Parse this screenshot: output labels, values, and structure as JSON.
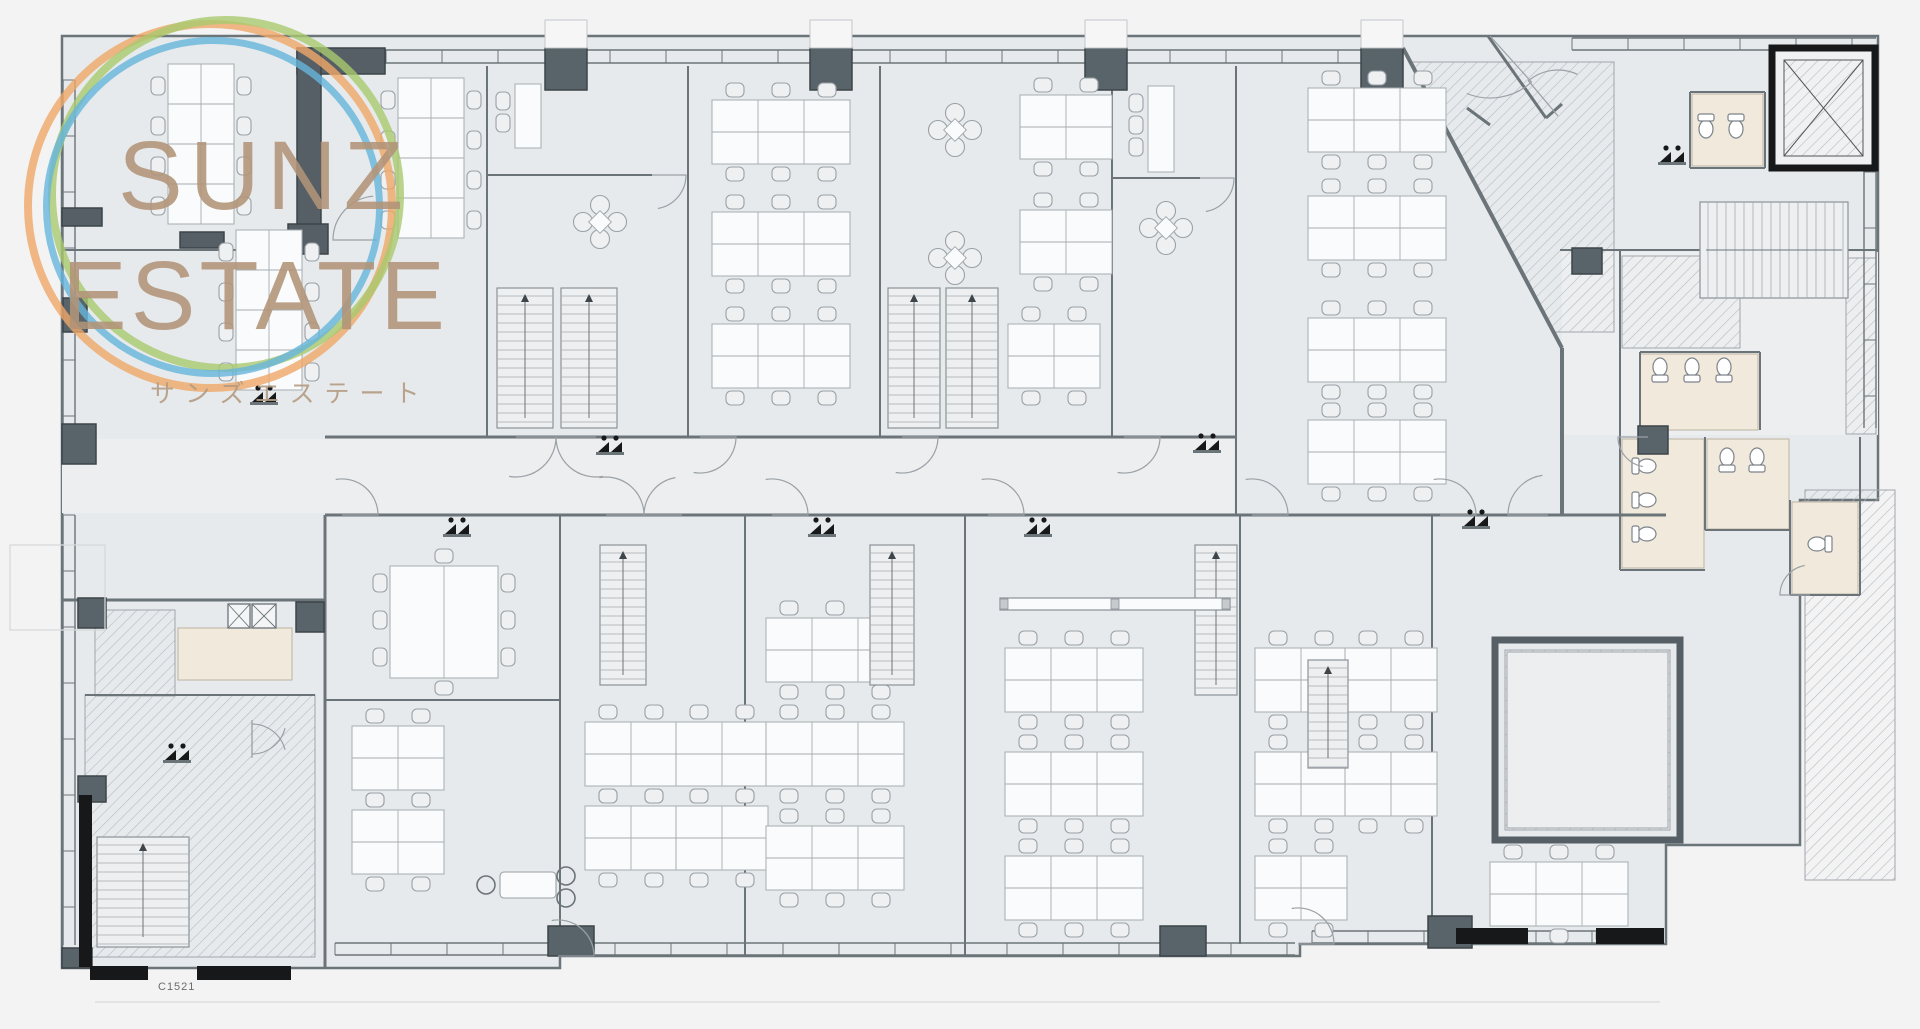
{
  "watermark": {
    "line1": "SUNZ",
    "line2": "ESTATE",
    "line3": "サンズエステート",
    "ring_colors": {
      "orange": "#efa768",
      "green": "#a9c96e",
      "blue": "#67b5dc"
    },
    "text_color": "#b29478"
  },
  "drawing_label": {
    "text": "C1521"
  },
  "palette": {
    "outside": "#f3f3f4",
    "floor": "#e7eaec",
    "floor2": "#eceef0",
    "wall": "#6b7479",
    "wall_dark": "#555f65",
    "column": "#59646a",
    "column_stroke": "#3d454a",
    "line": "#a0a6ab",
    "line_soft": "#c3c7cb",
    "white": "#fafbfc",
    "beige": "#f0e9dc",
    "beige_stroke": "#bcb2a1",
    "hatch": "#b6bbbf",
    "black": "#17181a"
  },
  "plan": {
    "outline": [
      [
        62,
        36
      ],
      [
        1878,
        36
      ],
      [
        1878,
        500
      ],
      [
        1800,
        500
      ],
      [
        1800,
        845
      ],
      [
        1666,
        845
      ],
      [
        1666,
        944
      ],
      [
        1300,
        944
      ],
      [
        1300,
        956
      ],
      [
        560,
        956
      ],
      [
        560,
        968
      ],
      [
        62,
        968
      ]
    ],
    "corridors": [
      [
        62,
        439,
        1172,
        74
      ],
      [
        1562,
        252,
        316,
        183
      ]
    ],
    "hatch_rects": [
      [
        95,
        610,
        80,
        86
      ],
      [
        85,
        695,
        230,
        262
      ],
      [
        1505,
        650,
        165,
        180
      ],
      [
        1805,
        490,
        90,
        390
      ],
      [
        1846,
        258,
        30,
        176
      ],
      [
        1622,
        256,
        118,
        92
      ]
    ],
    "hatch_polys": [
      [
        [
          1412,
          62
        ],
        [
          1554,
          332
        ],
        [
          1614,
          332
        ],
        [
          1614,
          62
        ]
      ]
    ],
    "beige_rooms": [
      [
        178,
        628,
        114,
        52
      ],
      [
        1622,
        439,
        82,
        129
      ],
      [
        1707,
        439,
        82,
        90
      ],
      [
        1792,
        502,
        66,
        92
      ],
      [
        1640,
        354,
        118,
        76
      ],
      [
        1692,
        94,
        71,
        72
      ]
    ],
    "facades": [
      {
        "d": "h",
        "a": 330,
        "b": 1398,
        "p": 50,
        "g": 13,
        "t": 56
      },
      {
        "d": "h",
        "a": 1572,
        "b": 1876,
        "p": 38,
        "g": 12,
        "t": 56
      },
      {
        "d": "v",
        "a": 80,
        "b": 430,
        "p": 63,
        "g": 12,
        "t": 56
      },
      {
        "d": "v",
        "a": 515,
        "b": 945,
        "p": 63,
        "g": 12,
        "t": 56
      },
      {
        "d": "h",
        "a": 335,
        "b": 1295,
        "p": 943,
        "g": 12,
        "t": 56
      },
      {
        "d": "h",
        "a": 1312,
        "b": 1660,
        "p": 931,
        "g": 12,
        "t": 56
      },
      {
        "d": "v",
        "a": 60,
        "b": 428,
        "p": 1864,
        "g": 12,
        "t": 56
      }
    ],
    "walls": [
      [
        487,
        66,
        487,
        437,
        2
      ],
      [
        688,
        66,
        688,
        437,
        2
      ],
      [
        880,
        66,
        880,
        437,
        2
      ],
      [
        1112,
        66,
        1112,
        437,
        2
      ],
      [
        1236,
        66,
        1236,
        515,
        2
      ],
      [
        487,
        175,
        652,
        175,
        2
      ],
      [
        1112,
        178,
        1200,
        178,
        2
      ],
      [
        325,
        437,
        1236,
        437,
        3
      ],
      [
        325,
        515,
        1666,
        515,
        3
      ],
      [
        62,
        250,
        298,
        250,
        2
      ],
      [
        325,
        515,
        325,
        968,
        3
      ],
      [
        560,
        515,
        560,
        956,
        2
      ],
      [
        745,
        515,
        745,
        956,
        2
      ],
      [
        965,
        515,
        965,
        956,
        2
      ],
      [
        1240,
        515,
        1240,
        944,
        2
      ],
      [
        1432,
        515,
        1432,
        944,
        2
      ],
      [
        325,
        700,
        560,
        700,
        2
      ],
      [
        62,
        600,
        325,
        600,
        3
      ],
      [
        85,
        695,
        315,
        695,
        2
      ],
      [
        1562,
        348,
        1562,
        515,
        4
      ],
      [
        1560,
        250,
        1878,
        250,
        2
      ],
      [
        1620,
        250,
        1620,
        437,
        2
      ],
      [
        1640,
        352,
        1640,
        430,
        2
      ],
      [
        1640,
        352,
        1760,
        352,
        2
      ],
      [
        1760,
        352,
        1760,
        430,
        2
      ],
      [
        1620,
        437,
        1620,
        570,
        2
      ],
      [
        1620,
        570,
        1705,
        570,
        2
      ],
      [
        1705,
        437,
        1705,
        530,
        2
      ],
      [
        1705,
        530,
        1790,
        530,
        2
      ],
      [
        1790,
        500,
        1790,
        595,
        2
      ],
      [
        1790,
        595,
        1860,
        595,
        2
      ],
      [
        1860,
        437,
        1860,
        595,
        2
      ],
      [
        1690,
        92,
        1690,
        168,
        2
      ],
      [
        1690,
        92,
        1765,
        92,
        2
      ],
      [
        1765,
        92,
        1765,
        168,
        2
      ],
      [
        1690,
        168,
        1765,
        168,
        2
      ],
      [
        1403,
        48,
        1562,
        348,
        4
      ],
      [
        1488,
        36,
        1546,
        118,
        3
      ],
      [
        1546,
        118,
        1562,
        104,
        3
      ],
      [
        1467,
        108,
        1490,
        125,
        3
      ]
    ],
    "columns": [
      [
        545,
        48,
        42,
        42
      ],
      [
        810,
        48,
        42,
        42
      ],
      [
        1085,
        48,
        42,
        42
      ],
      [
        1361,
        48,
        42,
        42
      ],
      [
        63,
        298,
        24,
        34
      ],
      [
        62,
        424,
        34,
        40
      ],
      [
        78,
        598,
        28,
        30
      ],
      [
        78,
        776,
        28,
        26
      ],
      [
        62,
        948,
        30,
        20
      ],
      [
        296,
        602,
        28,
        30
      ],
      [
        1638,
        426,
        30,
        28
      ],
      [
        1572,
        248,
        30,
        26
      ],
      [
        1750,
        248,
        36,
        26
      ],
      [
        548,
        926,
        46,
        30
      ],
      [
        1160,
        926,
        46,
        30
      ],
      [
        1428,
        916,
        44,
        32
      ]
    ],
    "dark_rects": [
      [
        297,
        48,
        88,
        26
      ],
      [
        297,
        48,
        24,
        180
      ],
      [
        288,
        224,
        40,
        30
      ],
      [
        180,
        232,
        44,
        16
      ],
      [
        62,
        208,
        40,
        18
      ]
    ],
    "black_rects": [
      [
        79,
        795,
        13,
        172
      ],
      [
        90,
        966,
        58,
        14
      ],
      [
        197,
        966,
        94,
        14
      ],
      [
        1456,
        928,
        72,
        16
      ],
      [
        1596,
        928,
        68,
        16
      ]
    ],
    "white_tops": [
      [
        545,
        20,
        42,
        28
      ],
      [
        810,
        20,
        42,
        28
      ],
      [
        1085,
        20,
        42,
        28
      ],
      [
        1361,
        20,
        42,
        28
      ]
    ],
    "clusters": [
      [
        712,
        100,
        3
      ],
      [
        712,
        212,
        3
      ],
      [
        712,
        324,
        3
      ],
      [
        1020,
        95,
        2
      ],
      [
        1020,
        210,
        2
      ],
      [
        1008,
        324,
        2
      ],
      [
        1308,
        88,
        3
      ],
      [
        1308,
        196,
        3
      ],
      [
        1308,
        318,
        3
      ],
      [
        1308,
        420,
        3
      ],
      [
        352,
        726,
        2
      ],
      [
        352,
        810,
        2
      ],
      [
        585,
        722,
        2
      ],
      [
        676,
        722,
        2
      ],
      [
        585,
        806,
        2
      ],
      [
        676,
        806,
        2
      ],
      [
        766,
        618,
        3
      ],
      [
        766,
        722,
        3
      ],
      [
        766,
        826,
        3
      ],
      [
        1005,
        648,
        3
      ],
      [
        1005,
        752,
        3
      ],
      [
        1005,
        856,
        3
      ],
      [
        1255,
        648,
        2
      ],
      [
        1345,
        648,
        2
      ],
      [
        1255,
        752,
        2
      ],
      [
        1345,
        752,
        2
      ],
      [
        1255,
        856,
        2
      ],
      [
        1490,
        862,
        3
      ]
    ],
    "vclusters": [
      [
        168,
        64,
        4
      ],
      [
        236,
        230,
        4
      ],
      [
        398,
        78,
        4
      ]
    ],
    "bigtables": [
      [
        390,
        566,
        108,
        112
      ]
    ],
    "desksv": [
      [
        515,
        84,
        2
      ],
      [
        1148,
        86,
        3
      ]
    ],
    "flowers": [
      [
        600,
        222
      ],
      [
        1166,
        228
      ],
      [
        955,
        130
      ],
      [
        955,
        258
      ]
    ],
    "stairs": [
      [
        497,
        288,
        56,
        140,
        "v"
      ],
      [
        561,
        288,
        56,
        140,
        "v"
      ],
      [
        888,
        288,
        52,
        140,
        "v"
      ],
      [
        946,
        288,
        52,
        140,
        "v"
      ],
      [
        600,
        545,
        46,
        140,
        "v"
      ],
      [
        870,
        545,
        44,
        140,
        "v"
      ],
      [
        1195,
        545,
        42,
        150,
        "v"
      ],
      [
        1308,
        660,
        40,
        108,
        "v"
      ],
      [
        97,
        837,
        92,
        110,
        "v"
      ],
      [
        1700,
        202,
        148,
        96,
        "h"
      ]
    ],
    "longtables": [
      [
        1000,
        598,
        230,
        12
      ]
    ],
    "nooks": [
      [
        500,
        872
      ]
    ],
    "thick_rooms": [
      [
        1495,
        640,
        185,
        200
      ]
    ],
    "elevators": [
      [
        1772,
        48,
        103,
        120
      ]
    ],
    "xboxes": [
      [
        228,
        604,
        22,
        24
      ],
      [
        252,
        604,
        24,
        24
      ]
    ],
    "toilets": [
      [
        1706,
        124,
        0
      ],
      [
        1736,
        124,
        0
      ],
      [
        1642,
        466,
        -90
      ],
      [
        1642,
        500,
        -90
      ],
      [
        1642,
        534,
        -90
      ],
      [
        1727,
        462,
        180
      ],
      [
        1757,
        462,
        180
      ],
      [
        1822,
        544,
        90
      ],
      [
        1660,
        372,
        180
      ],
      [
        1692,
        372,
        180
      ],
      [
        1724,
        372,
        180
      ]
    ],
    "arcs": [
      [
        516,
        437,
        40,
        0,
        100
      ],
      [
        596,
        437,
        40,
        180,
        80
      ],
      [
        700,
        437,
        36,
        0,
        100
      ],
      [
        902,
        437,
        36,
        0,
        100
      ],
      [
        1124,
        437,
        36,
        0,
        100
      ],
      [
        1548,
        515,
        40,
        180,
        262
      ],
      [
        342,
        515,
        36,
        0,
        -100
      ],
      [
        606,
        515,
        38,
        0,
        -100
      ],
      [
        682,
        515,
        38,
        180,
        260
      ],
      [
        772,
        515,
        36,
        0,
        -100
      ],
      [
        988,
        515,
        36,
        0,
        -100
      ],
      [
        1252,
        515,
        36,
        0,
        -100
      ],
      [
        1440,
        515,
        36,
        0,
        -100
      ],
      [
        652,
        175,
        34,
        0,
        80
      ],
      [
        1200,
        178,
        34,
        0,
        80
      ],
      [
        377,
        240,
        44,
        180,
        265
      ],
      [
        252,
        720,
        34,
        90,
        14
      ],
      [
        252,
        758,
        34,
        -90,
        -14
      ],
      [
        1490,
        36,
        62,
        48,
        112
      ],
      [
        1558,
        116,
        46,
        230,
        295
      ],
      [
        1648,
        437,
        30,
        180,
        100
      ],
      [
        1810,
        595,
        30,
        180,
        260
      ],
      [
        558,
        956,
        36,
        0,
        -100
      ],
      [
        1298,
        944,
        36,
        0,
        -100
      ]
    ],
    "sinks": [
      [
        598,
        442
      ],
      [
        1195,
        440
      ],
      [
        445,
        524
      ],
      [
        810,
        524
      ],
      [
        1026,
        524
      ],
      [
        1464,
        516
      ],
      [
        252,
        392
      ],
      [
        165,
        750
      ],
      [
        1660,
        152
      ]
    ],
    "outside_lines": [
      [
        95,
        1002,
        1660,
        1002
      ]
    ],
    "outside_rects": [
      [
        10,
        545,
        95,
        85
      ]
    ]
  }
}
